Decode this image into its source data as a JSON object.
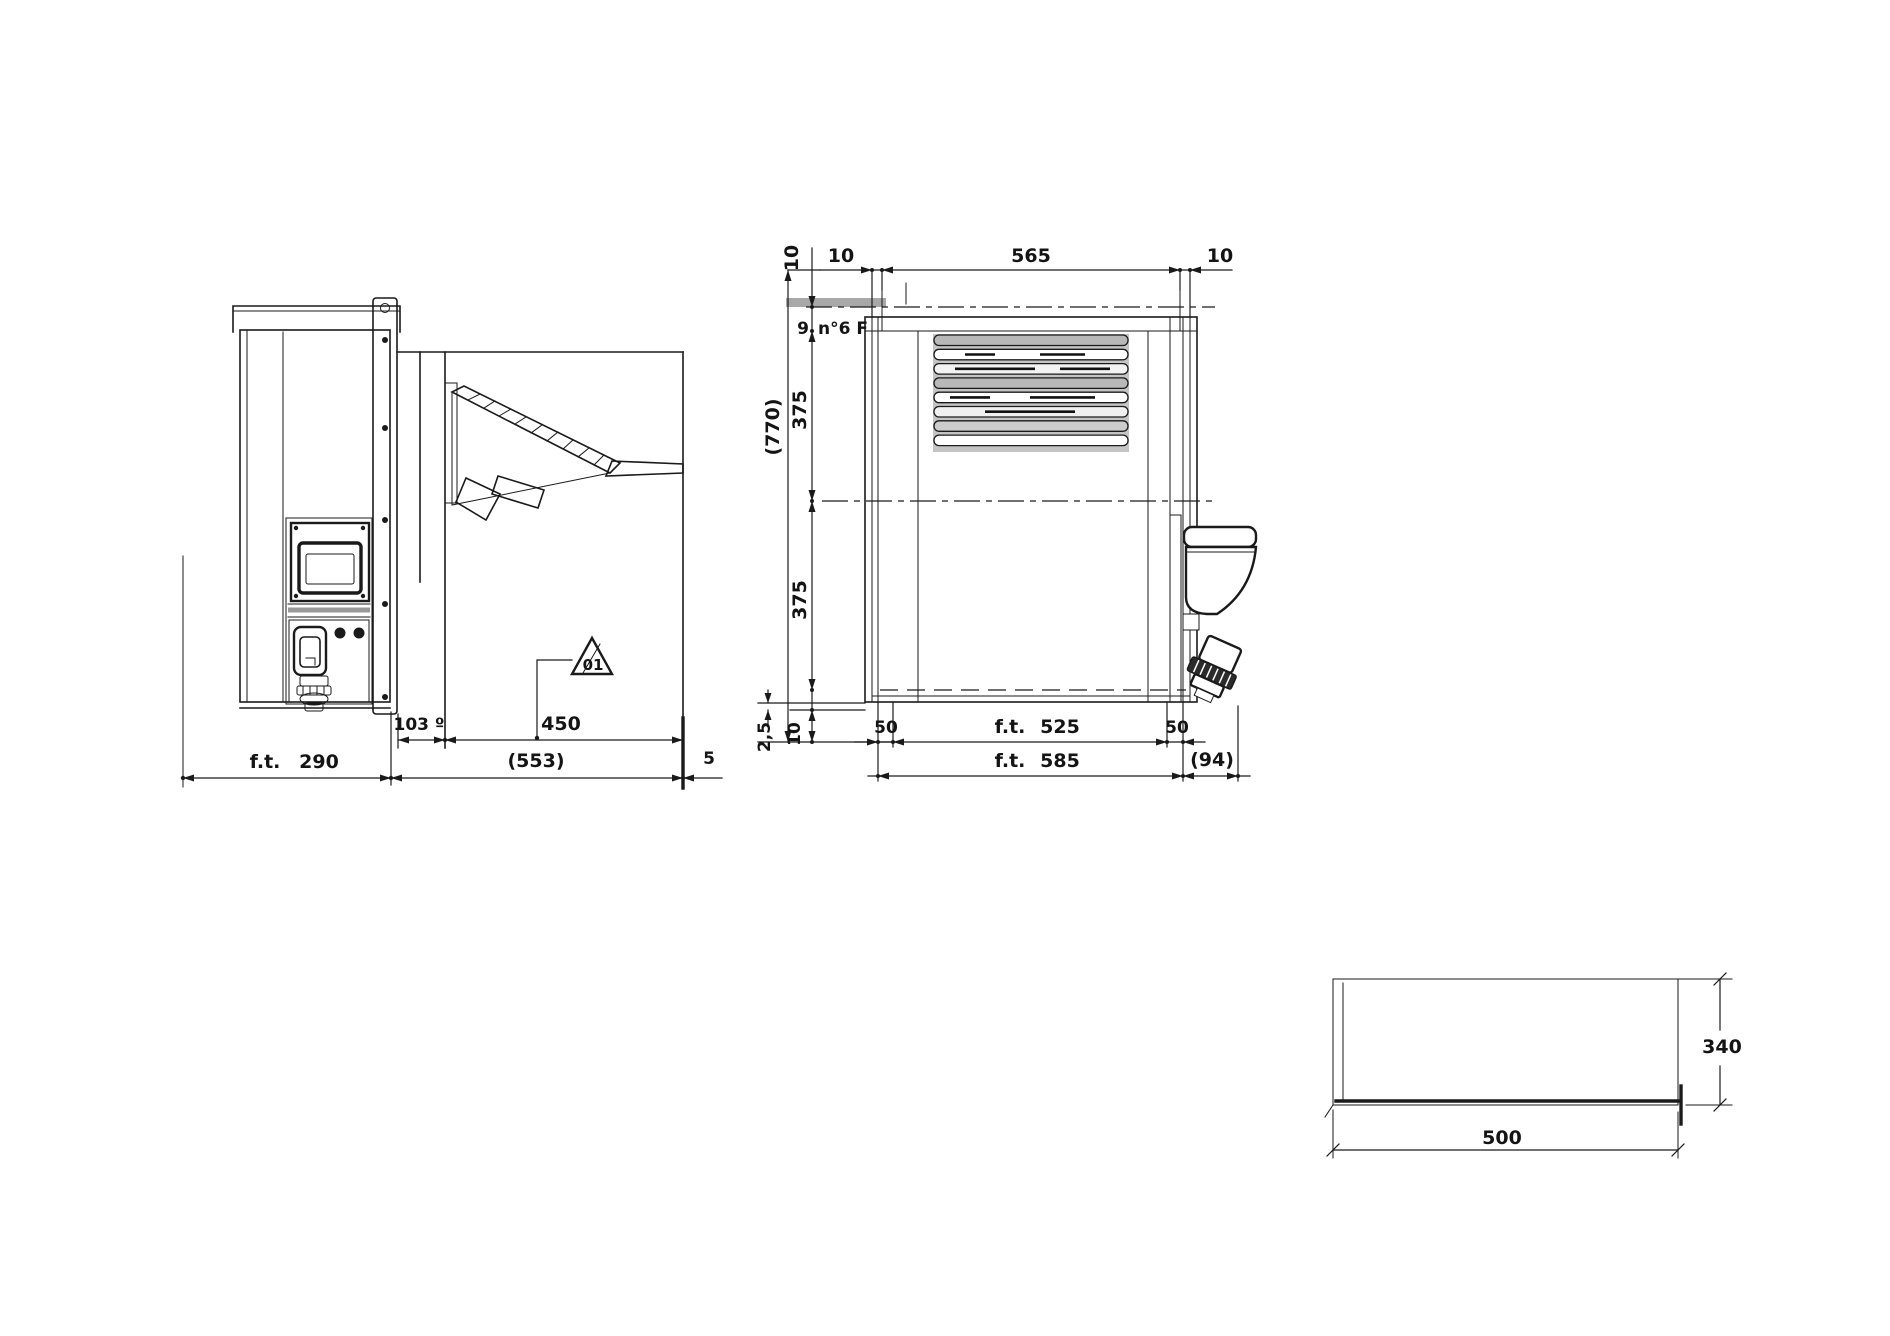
{
  "colors": {
    "ink": "#1a1a1a",
    "grille_gray": "#c4c4c4",
    "strip_gray": "#a8a8a8"
  },
  "side_view": {
    "labels": {
      "dim_103": "103 º",
      "dim_450": "450",
      "dim_553": "(553)",
      "ft_label": "f.t.",
      "dim_290": "290",
      "dim_5": "5",
      "triangle_ref": "01"
    }
  },
  "rear_view": {
    "labels": {
      "top_offset_10_vertical": "10",
      "top_10_left": "10",
      "top_565": "565",
      "top_10_right": "10",
      "dim_9": "9",
      "holes_note": "n°6 F",
      "overall_770": "(770)",
      "dim_375_upper": "375",
      "dim_375_lower": "375",
      "dim_2_5": "2,5",
      "dim_10_bottom": "10",
      "dim_50_left": "50",
      "ft_label_525": "f.t.",
      "dim_525": "525",
      "dim_50_right": "50",
      "ft_label_585": "f.t.",
      "dim_585": "585",
      "dim_94": "(94)"
    }
  },
  "cutout_view": {
    "labels": {
      "dim_340": "340",
      "dim_500": "500"
    }
  }
}
